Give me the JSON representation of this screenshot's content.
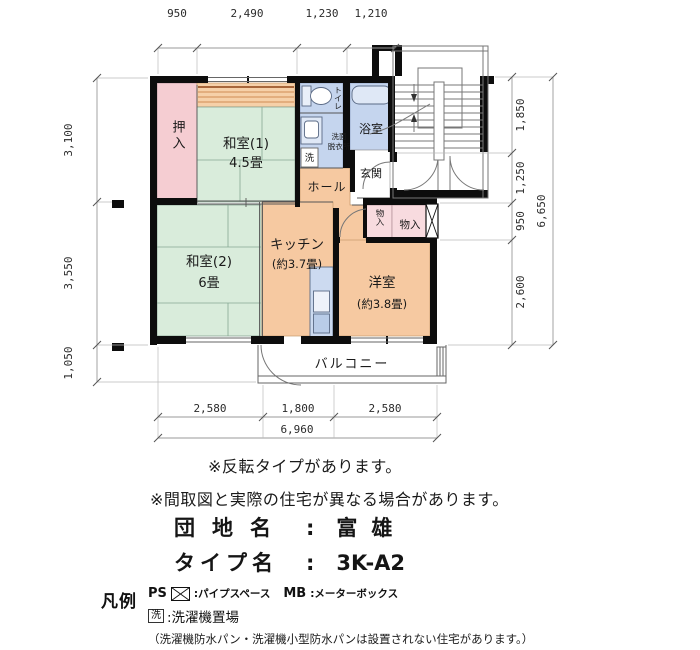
{
  "colors": {
    "wall": "#0d0d0d",
    "tatami_green": "#d9ecdb",
    "closet_pink": "#f5cdd2",
    "flooring_orange": "#f6c9a1",
    "wet_blue": "#c5d5ee",
    "storage_pink": "#f8dbdf",
    "band_orange": "#f6d0a8"
  },
  "plan": {
    "dims_top": [
      "950",
      "2,490",
      "1,230",
      "1,210"
    ],
    "dims_left": [
      "3,100",
      "3,550",
      "1,050"
    ],
    "dims_right": [
      "1,850",
      "1,250",
      "950",
      "2,600"
    ],
    "dims_right_total": "6,650",
    "dims_bottom": [
      "2,580",
      "1,800",
      "2,580"
    ],
    "dims_bottom_total": "6,960",
    "rooms": {
      "oshiire": "押入",
      "washitsu1": "和室(1)",
      "washitsu1_size": "4.5畳",
      "toilet": "トイレ",
      "senmen1": "洗面",
      "senmen2": "脱衣所",
      "laundry": "洗",
      "bath": "浴室",
      "genkan": "玄関",
      "hall": "ホール",
      "storage1": "物入",
      "storage2": "物入",
      "washitsu2": "和室(2)",
      "washitsu2_size": "6畳",
      "kitchen": "キッチン",
      "kitchen_size": "(約3.7畳)",
      "youshitsu": "洋室",
      "youshitsu_size": "(約3.8畳)",
      "balcony": "バルコニー"
    }
  },
  "notes": {
    "note1": "※反転タイプがあります。",
    "note2": "※間取図と実際の住宅が異なる場合があります。"
  },
  "info": {
    "estate_label": "団地名",
    "estate_sep": ":",
    "estate_value": "富雄",
    "type_label": "タイプ名",
    "type_sep": ":",
    "type_value": "3K-A2"
  },
  "legend": {
    "title": "凡例",
    "ps": "PS",
    "ps_desc": ":パイプスペース",
    "mb": "MB",
    "mb_desc": ":メーターボックス",
    "laundry_mark": "洗",
    "laundry_desc": ":洗濯機置場",
    "note": "（洗濯機防水パン・洗濯機小型防水パンは設置されない住宅があります。）"
  }
}
